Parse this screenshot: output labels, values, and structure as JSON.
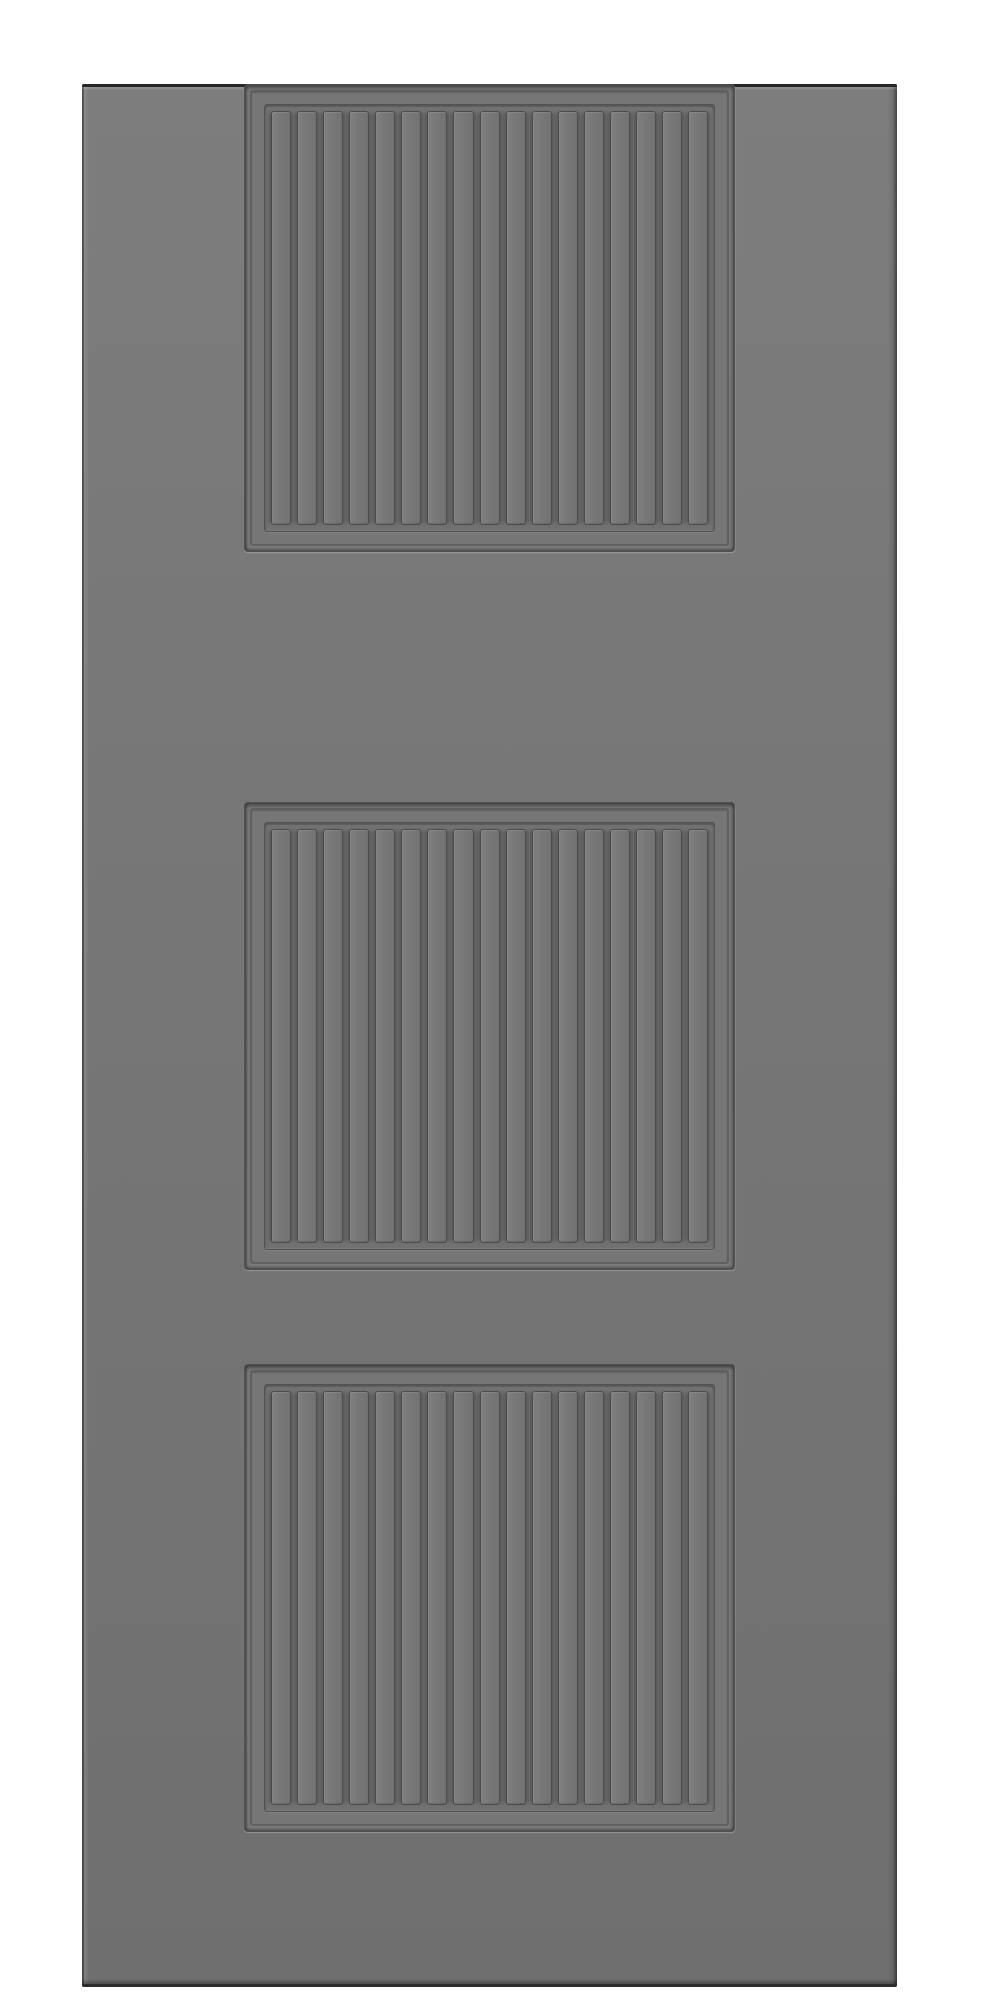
{
  "scene": {
    "subject": "front view render of a plain gray door leaf with three identical recessed square panels, each filled with vertical beadboard slats",
    "background_color": "#ffffff",
    "door": {
      "face_color": "#757575",
      "top_edge_color": "#262626",
      "bottom_edge_color": "#2d2d2d",
      "groove_color": "#5e5e5e",
      "slat_highlight_color": "#7f7f7f"
    },
    "panels": {
      "count": 3,
      "slats_per_panel": 17
    }
  }
}
